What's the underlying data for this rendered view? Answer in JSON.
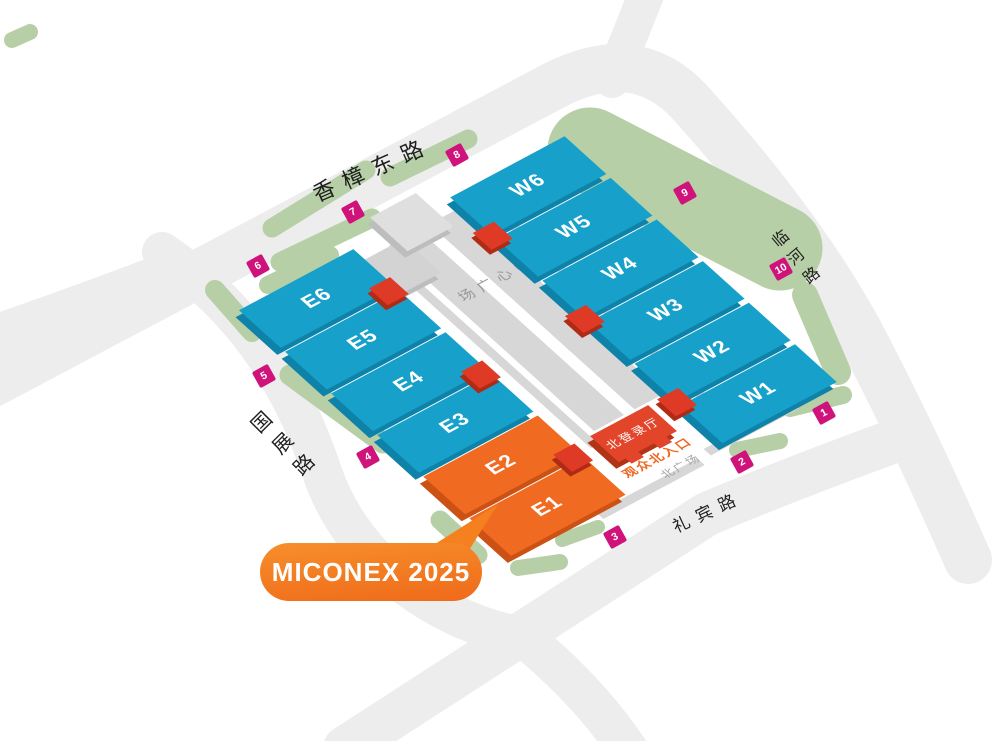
{
  "roads": {
    "top": "香樟东路",
    "left": "国展路",
    "right": "临河路",
    "bottom": "礼宾路"
  },
  "halls": {
    "east": [
      {
        "label": "E6"
      },
      {
        "label": "E5"
      },
      {
        "label": "E4"
      },
      {
        "label": "E3"
      },
      {
        "label": "E2"
      },
      {
        "label": "E1"
      }
    ],
    "west": [
      {
        "label": "W6"
      },
      {
        "label": "W5"
      },
      {
        "label": "W4"
      },
      {
        "label": "W3"
      },
      {
        "label": "W2"
      },
      {
        "label": "W1"
      }
    ],
    "highlighted": [
      "E2",
      "E1"
    ]
  },
  "plaza": {
    "label": "中心广场"
  },
  "registration_hall": {
    "label": "北登录厅"
  },
  "entrance": {
    "label": "观众北入口",
    "sublabel": "北广场"
  },
  "gates": [
    {
      "number": "1"
    },
    {
      "number": "2"
    },
    {
      "number": "3"
    },
    {
      "number": "4"
    },
    {
      "number": "5"
    },
    {
      "number": "6"
    },
    {
      "number": "7"
    },
    {
      "number": "8"
    },
    {
      "number": "9"
    },
    {
      "number": "10"
    }
  ],
  "callout": {
    "label": "MICONEX 2025"
  },
  "colors": {
    "hall_blue": "#17a1ca",
    "hall_blue_side": "#0e82a8",
    "hall_orange": "#f16a22",
    "hall_orange_side": "#cc5114",
    "entrance_red": "#df3a26",
    "gate_magenta": "#d0137b",
    "green": "#b7cfa6",
    "road_gray": "#ededed",
    "plaza_gray": "#d7d7d7",
    "building_gray": "#d8d8d8",
    "callout_orange": "#f5801f"
  }
}
